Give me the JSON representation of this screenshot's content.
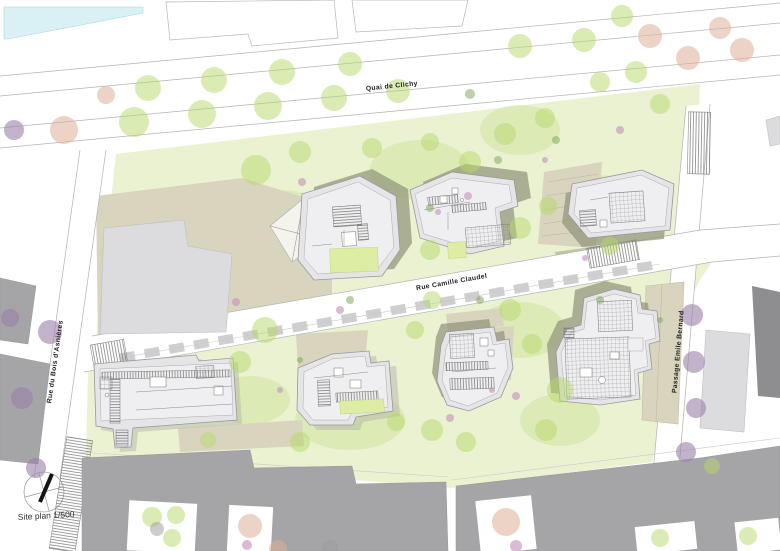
{
  "plan": {
    "scale_label": "Site plan 1/500",
    "streets": {
      "quai_de_clichy": "Quai de Clichy",
      "rue_camille_claudel": "Rue Camille Claudel",
      "rue_du_bois_dasnieres": "Rue du Bois d'Asnières",
      "passage_emile_bernard": "Passage Emile Bernard"
    },
    "colors": {
      "water": "#d9f1f4",
      "lawn": "#eaf2d2",
      "lawn_patch": "#cde394",
      "tree_green": "#b5d76a",
      "tree_salmon": "#ddae96",
      "tree_purple": "#9a7fa8",
      "tree_pink": "#c795bd",
      "tree_dark": "#7ba257",
      "tree_gray": "#9b9b9d",
      "terrain_beige": "#d9d4bd",
      "shadow_olive": "#8e9377",
      "roof_gray": "#e5e5e7",
      "roof_inner": "#efeff1",
      "roof_green": "#ddeda3",
      "context_gray": "#a5a5a7",
      "context_dark": "#8e8e91",
      "context_light": "#dcdcdf",
      "road_line": "#b2b2b4",
      "label_text": "#1d1d1d"
    }
  }
}
